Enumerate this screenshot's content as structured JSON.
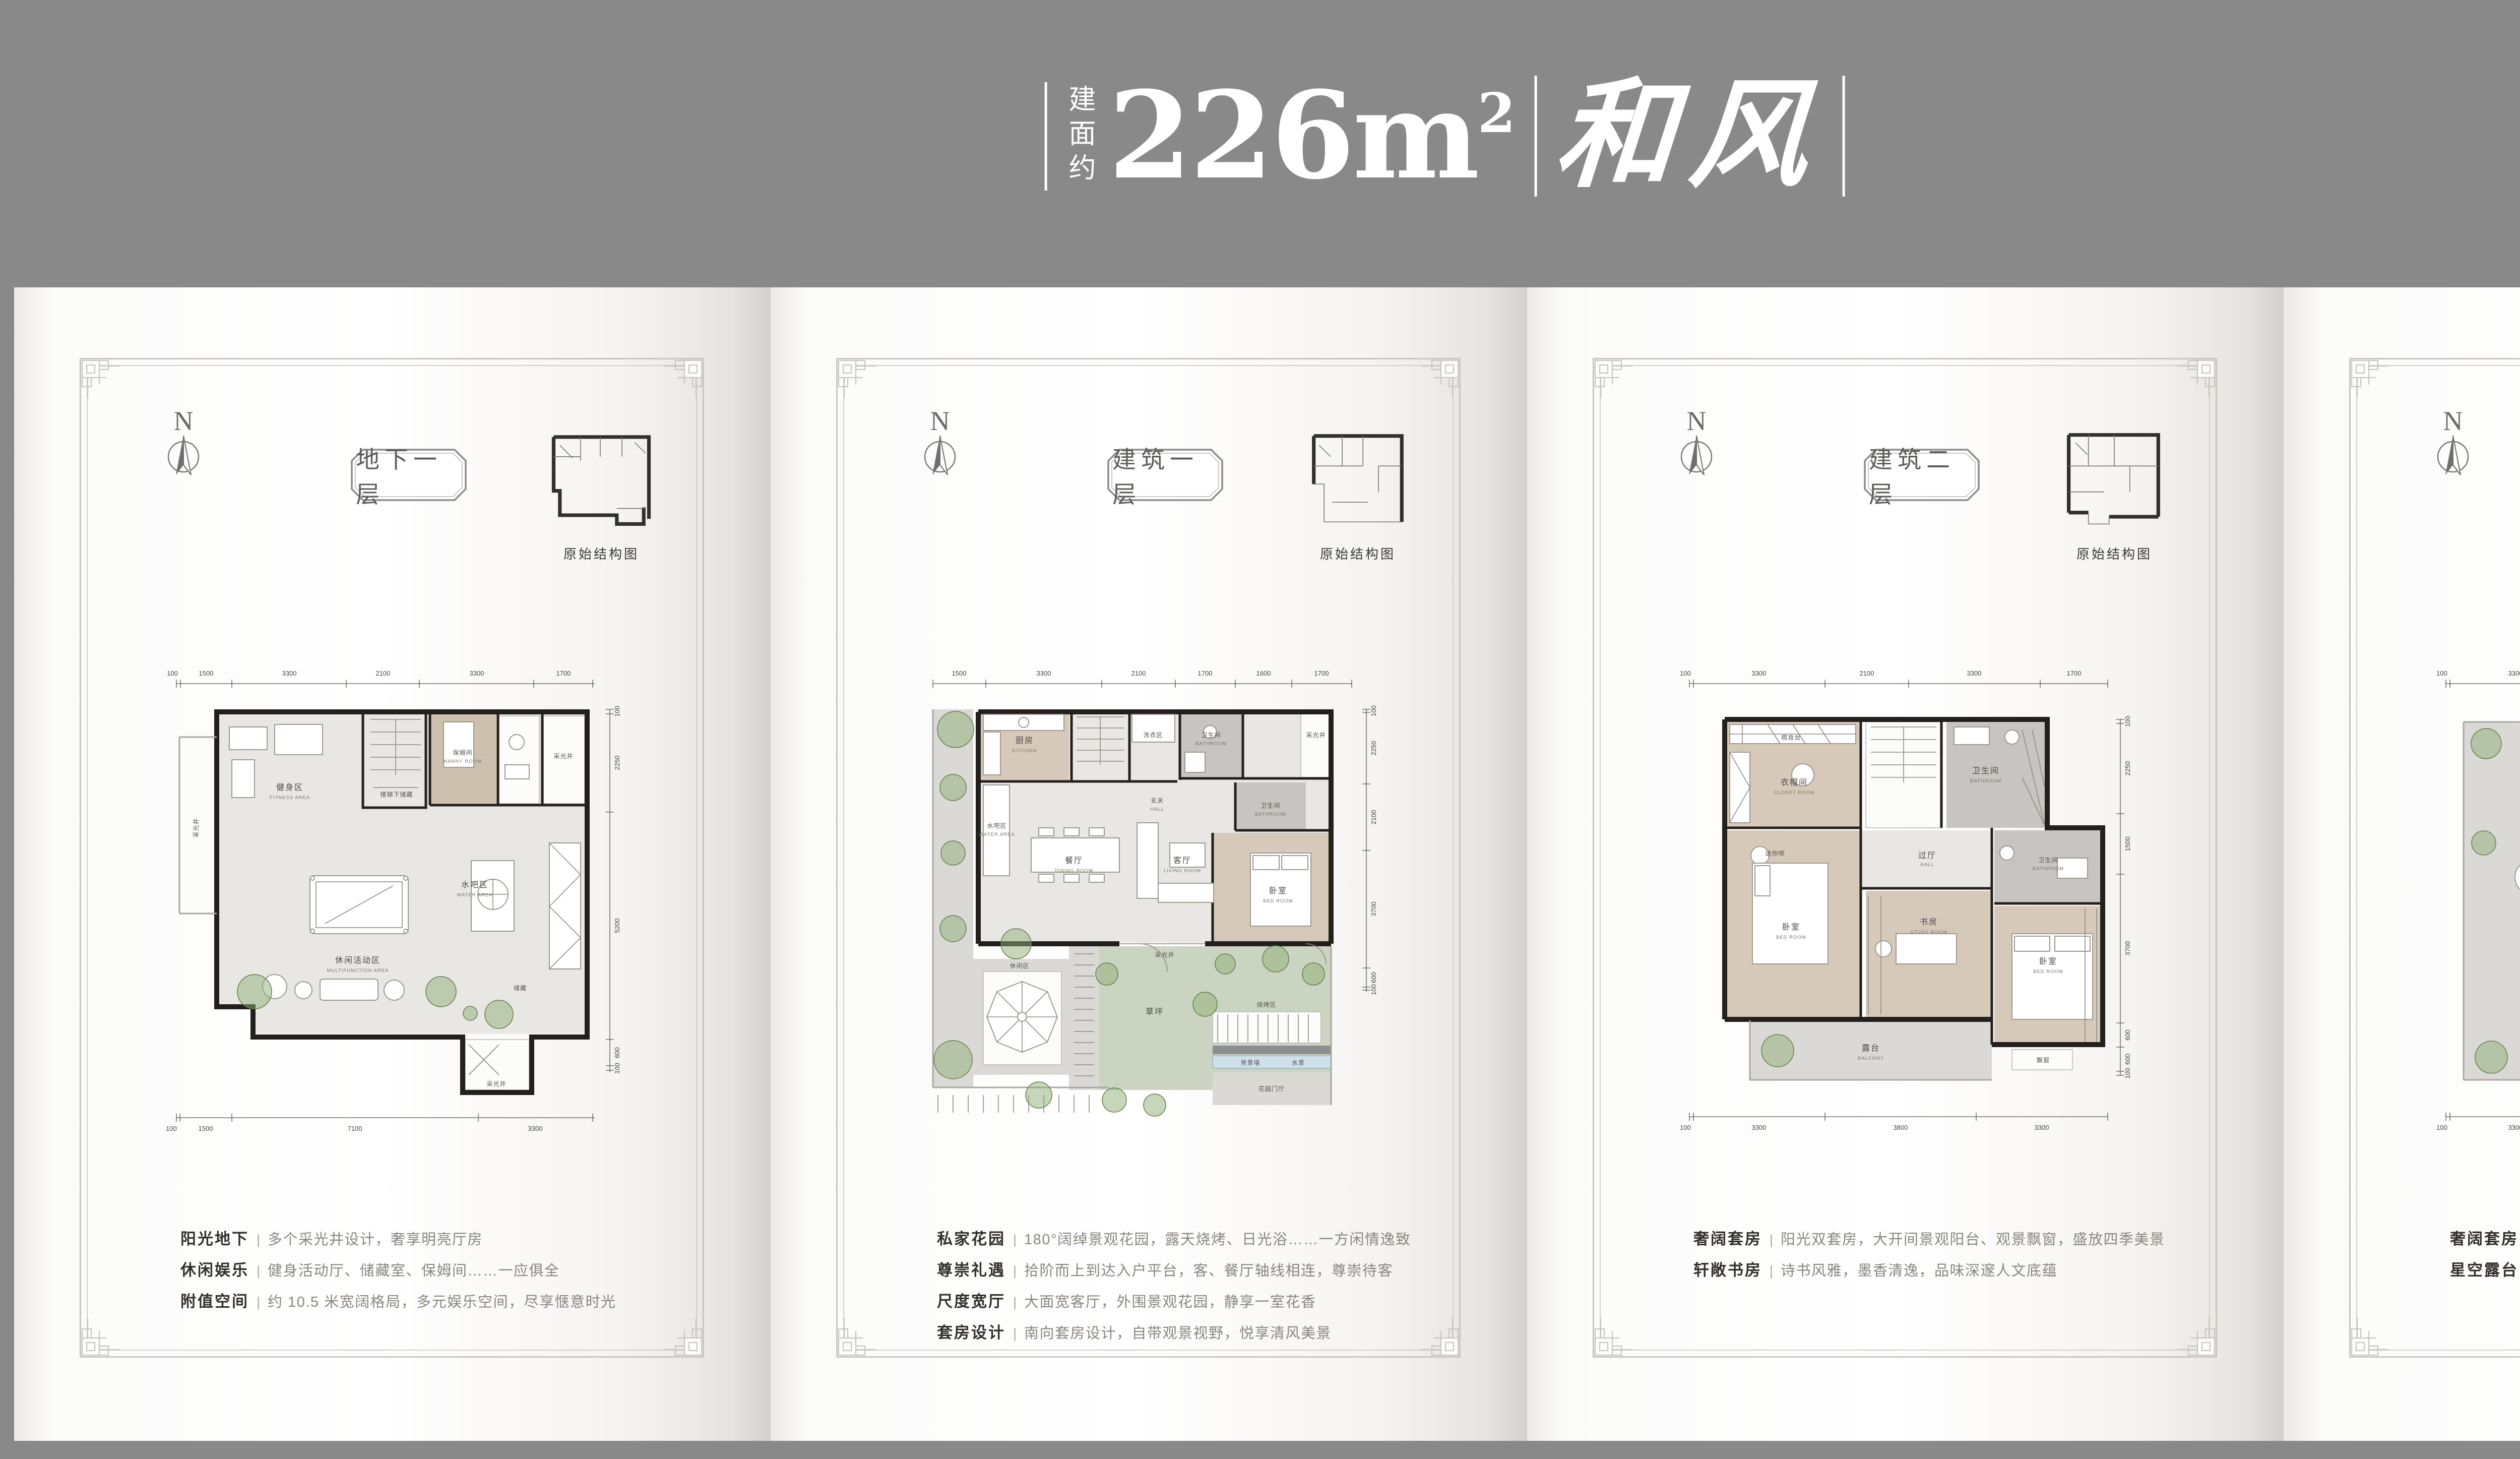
{
  "ui": {
    "separator": "|"
  },
  "colors": {
    "background": "#898989",
    "page": "#ffffff",
    "wall": "#221f1c",
    "lawn": "#cbd4c1",
    "wood": "#d6c9b9",
    "bath": "#c7c4c1",
    "tree": "#8fae76",
    "water": "#cfe0ea",
    "label_dark": "#332e28",
    "label_gray": "#8b867f"
  },
  "header": {
    "area_prefix": "建面约",
    "area_number": "226m",
    "area_sup": "2",
    "project_name": "和风"
  },
  "panels": [
    {
      "title": "地下一层",
      "compass": "N",
      "inset_label": "原始结构图",
      "features": [
        {
          "label": "阳光地下",
          "desc": "多个采光井设计，奢享明亮厅房"
        },
        {
          "label": "休闲娱乐",
          "desc": "健身活动厅、储藏室、保姆间……一应俱全"
        },
        {
          "label": "附值空间",
          "desc": "约 10.5 米宽阔格局，多元娱乐空间，尽享惬意时光"
        }
      ],
      "plan": {
        "dims_top": [
          "100",
          "1500",
          "3300",
          "2100",
          "3300",
          "1700"
        ],
        "dims_right": [
          "100",
          "2250",
          "5200",
          "600",
          "100"
        ],
        "dims_bottom": [
          "100",
          "1500",
          "7100",
          "3300"
        ],
        "rooms": [
          {
            "cn": "采光井",
            "en": ""
          },
          {
            "cn": "健身区",
            "en": "FITNESS AREA"
          },
          {
            "cn": "楼梯下储藏",
            "en": ""
          },
          {
            "cn": "保姆间",
            "en": "NANNY ROOM"
          },
          {
            "cn": "采光井",
            "en": ""
          },
          {
            "cn": "休闲活动区",
            "en": "MULTIFUNCTION AREA"
          },
          {
            "cn": "水吧区",
            "en": "WATER AREA"
          },
          {
            "cn": "储藏",
            "en": ""
          },
          {
            "cn": "采光井",
            "en": ""
          }
        ]
      }
    },
    {
      "title": "建筑一层",
      "compass": "N",
      "inset_label": "原始结构图",
      "features": [
        {
          "label": "私家花园",
          "desc": "180°阔绰景观花园，露天烧烤、日光浴……一方闲情逸致"
        },
        {
          "label": "尊崇礼遇",
          "desc": "拾阶而上到达入户平台，客、餐厅轴线相连，尊崇待客"
        },
        {
          "label": "尺度宽厅",
          "desc": "大面宽客厅，外围景观花园，静享一室花香"
        },
        {
          "label": "套房设计",
          "desc": "南向套房设计，自带观景视野，悦享清风美景"
        }
      ],
      "plan": {
        "dims_top": [
          "1500",
          "3300",
          "2100",
          "1700",
          "1600",
          "1700"
        ],
        "dims_right": [
          "100",
          "2250",
          "2100",
          "3700",
          "600",
          "100"
        ],
        "dims_bottom": [],
        "rooms": [
          {
            "cn": "厨房",
            "en": "KITCHEN"
          },
          {
            "cn": "洗衣区",
            "en": ""
          },
          {
            "cn": "卫生间",
            "en": "BATHROOM"
          },
          {
            "cn": "采光井",
            "en": ""
          },
          {
            "cn": "水吧区",
            "en": "WATER AREA"
          },
          {
            "cn": "玄关",
            "en": "HALL"
          },
          {
            "cn": "餐厅",
            "en": "DINING ROOM"
          },
          {
            "cn": "客厅",
            "en": "LIVING ROOM"
          },
          {
            "cn": "卫生间",
            "en": "BATHROOM"
          },
          {
            "cn": "卧室",
            "en": "BED ROOM"
          },
          {
            "cn": "采光井",
            "en": ""
          },
          {
            "cn": "草坪",
            "en": ""
          },
          {
            "cn": "休闲区",
            "en": ""
          },
          {
            "cn": "烧烤区",
            "en": ""
          },
          {
            "cn": "背景墙",
            "en": ""
          },
          {
            "cn": "水景",
            "en": ""
          },
          {
            "cn": "花园门厅",
            "en": ""
          }
        ]
      }
    },
    {
      "title": "建筑二层",
      "compass": "N",
      "inset_label": "原始结构图",
      "features": [
        {
          "label": "奢阔套房",
          "desc": "阳光双套房，大开间景观阳台、观景飘窗，盛放四季美景"
        },
        {
          "label": "轩敞书房",
          "desc": "诗书风雅，墨香清逸，品味深邃人文底蕴"
        }
      ],
      "plan": {
        "dims_top": [
          "100",
          "3300",
          "2100",
          "3300",
          "1700"
        ],
        "dims_right": [
          "100",
          "2250",
          "1500",
          "3700",
          "600",
          "600",
          "100"
        ],
        "dims_bottom": [
          "100",
          "3300",
          "3800",
          "3300"
        ],
        "rooms": [
          {
            "cn": "梳妆台",
            "en": ""
          },
          {
            "cn": "衣帽间",
            "en": "CLOSET ROOM"
          },
          {
            "cn": "卫生间",
            "en": "BATHROOM"
          },
          {
            "cn": "迷你吧",
            "en": ""
          },
          {
            "cn": "过厅",
            "en": "HALL"
          },
          {
            "cn": "卧室",
            "en": "BED ROOM"
          },
          {
            "cn": "书房",
            "en": "STUDY ROOM"
          },
          {
            "cn": "卫生间",
            "en": "BATHROOM"
          },
          {
            "cn": "卧室",
            "en": "BED ROOM"
          },
          {
            "cn": "露台",
            "en": "BALCONY"
          },
          {
            "cn": "飘窗",
            "en": ""
          }
        ]
      }
    },
    {
      "title": "建筑三层",
      "compass": "N",
      "inset_label": "原始结构图",
      "features": [
        {
          "label": "奢阔套房",
          "desc": "大开间主卧套房，私享衣帽间、独立卫浴、观景书房，尽显尊荣"
        },
        {
          "label": "星空露台",
          "desc": "一把藤椅，品一杯香茗，宁静致远，浸润悠闲时光"
        }
      ],
      "plan": {
        "dims_top": [
          "100",
          "3300",
          "2100",
          "3300",
          "1700"
        ],
        "dims_right": [
          "100",
          "2250",
          "2000",
          "3200",
          "600",
          "600",
          "100"
        ],
        "dims_bottom": [
          "100",
          "3300",
          "3800",
          "3300"
        ],
        "rooms": [
          {
            "cn": "露台",
            "en": "BALCONY"
          },
          {
            "cn": "主卫生间",
            "en": "BATHROOM"
          },
          {
            "cn": "过厅",
            "en": "HALL"
          },
          {
            "cn": "门厅",
            "en": "HALL"
          },
          {
            "cn": "衣帽间",
            "en": "CLOAKROOM"
          },
          {
            "cn": "书房",
            "en": "STUDY ROOM"
          },
          {
            "cn": "主卧室",
            "en": "BED ROOM"
          },
          {
            "cn": "飘窗",
            "en": ""
          },
          {
            "cn": "飘窗",
            "en": ""
          }
        ]
      }
    }
  ]
}
